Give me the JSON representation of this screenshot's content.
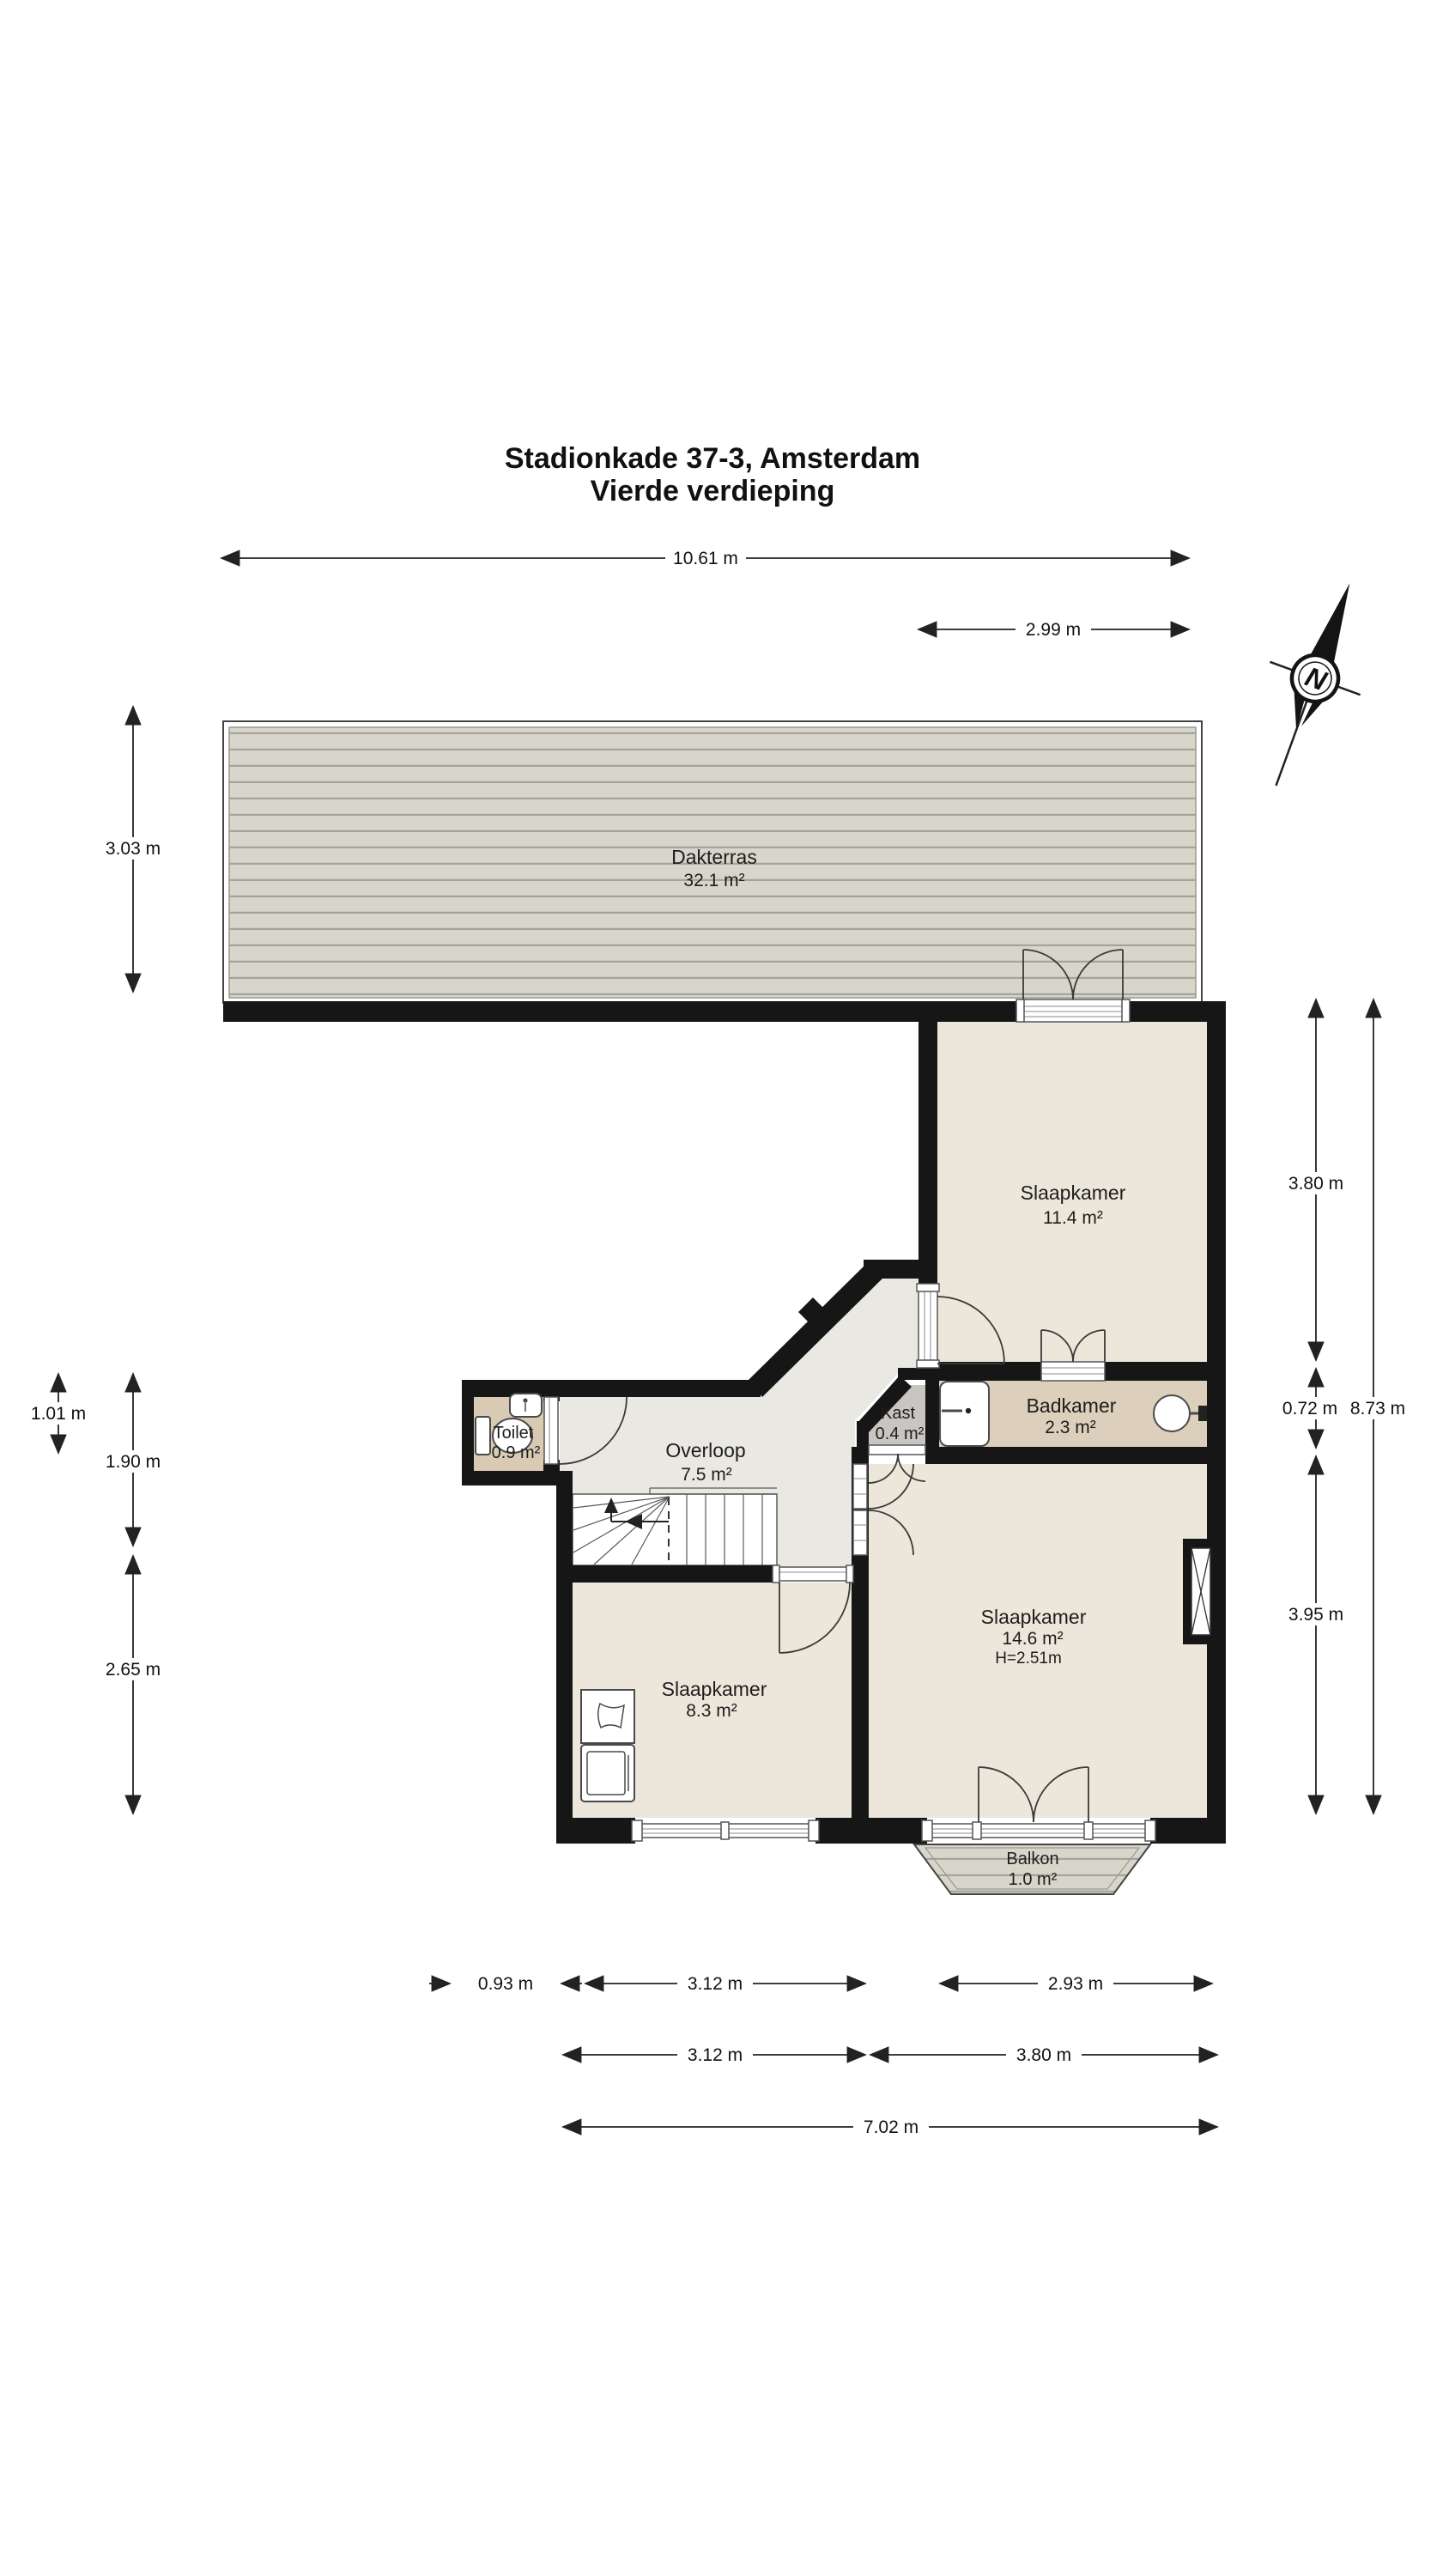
{
  "title": {
    "line1": "Stadionkade 37-3, Amsterdam",
    "line2": "Vierde verdieping"
  },
  "compass": {
    "north": "N"
  },
  "rooms": {
    "dakterras": {
      "name": "Dakterras",
      "area": "32.1 m²"
    },
    "slaapkamer_11": {
      "name": "Slaapkamer",
      "area": "11.4 m²"
    },
    "toilet": {
      "name": "Toilet",
      "area": "0.9 m²"
    },
    "overloop": {
      "name": "Overloop",
      "area": "7.5 m²"
    },
    "kast": {
      "name": "Kast",
      "area": "0.4 m²"
    },
    "badkamer": {
      "name": "Badkamer",
      "area": "2.3 m²"
    },
    "slaapkamer_14": {
      "name": "Slaapkamer",
      "area": "14.6 m²",
      "height": "H=2.51m"
    },
    "slaapkamer_8": {
      "name": "Slaapkamer",
      "area": "8.3 m²"
    },
    "balkon": {
      "name": "Balkon",
      "area": "1.0 m²"
    }
  },
  "dimensions": {
    "top_total": "10.61 m",
    "top_right": "2.99 m",
    "left_terrace": "3.03 m",
    "left_toilet": "1.01 m",
    "left_mid": "1.90 m",
    "left_lower": "2.65 m",
    "right_upper": "3.80 m",
    "right_bath": "0.72 m",
    "right_lower": "3.95 m",
    "right_total": "8.73 m",
    "bottom_offset": "0.93 m",
    "bottom_room_left": "3.12 m",
    "bottom_room_right": "2.93 m",
    "bottom2_left": "3.12 m",
    "bottom2_right": "3.80 m",
    "bottom_total": "7.02 m"
  }
}
